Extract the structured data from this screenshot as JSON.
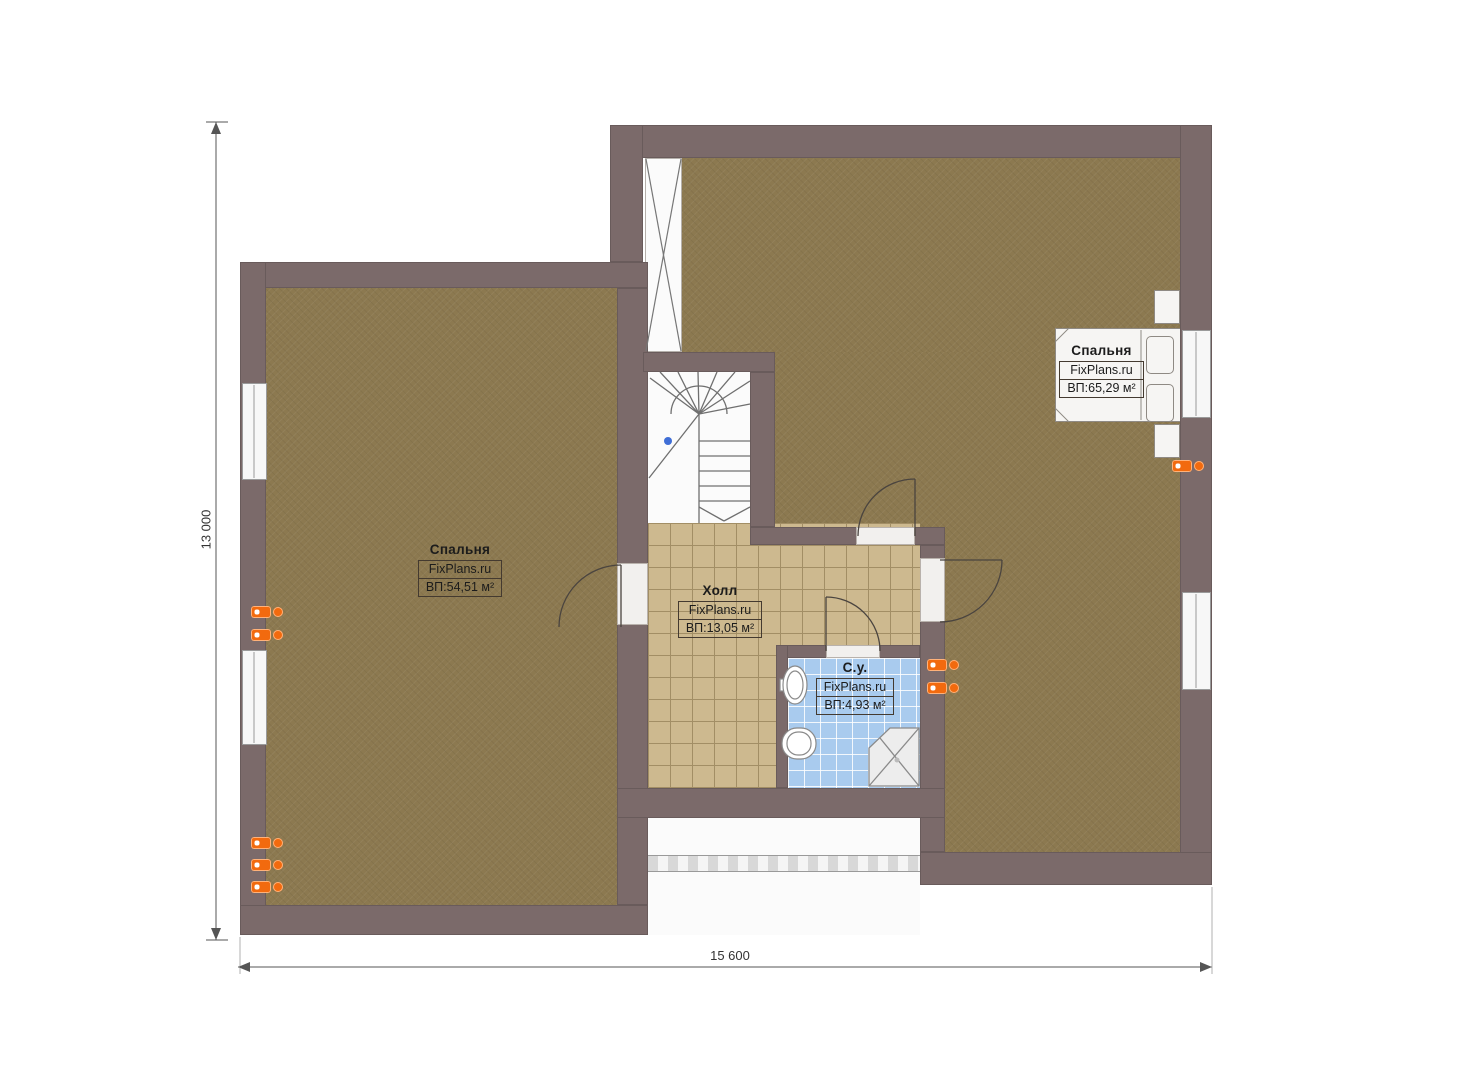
{
  "plan": {
    "brand": "FixPlans.ru",
    "dimensions": {
      "height_label": "13 000",
      "width_label": "15 600"
    },
    "rooms": [
      {
        "id": "bedroom-left",
        "name": "Спальня",
        "brand": "FixPlans.ru",
        "area": "ВП:54,51 м²"
      },
      {
        "id": "hall",
        "name": "Холл",
        "brand": "FixPlans.ru",
        "area": "ВП:13,05 м²"
      },
      {
        "id": "bathroom",
        "name": "С.у.",
        "brand": "FixPlans.ru",
        "area": "ВП:4,93 м²"
      },
      {
        "id": "bedroom-right",
        "name": "Спальня",
        "brand": "FixPlans.ru",
        "area": "ВП:65,29 м²"
      }
    ],
    "colors": {
      "wall": "#7b6a6a",
      "floor-wood": "#8c7950",
      "hall-tile": "#cdb98f",
      "hall-grout": "#a28e65",
      "bath-tile": "#a9cbee",
      "radiator": "#f26a0e",
      "label-border": "#443a30",
      "label-text": "#1c1c1c"
    }
  }
}
